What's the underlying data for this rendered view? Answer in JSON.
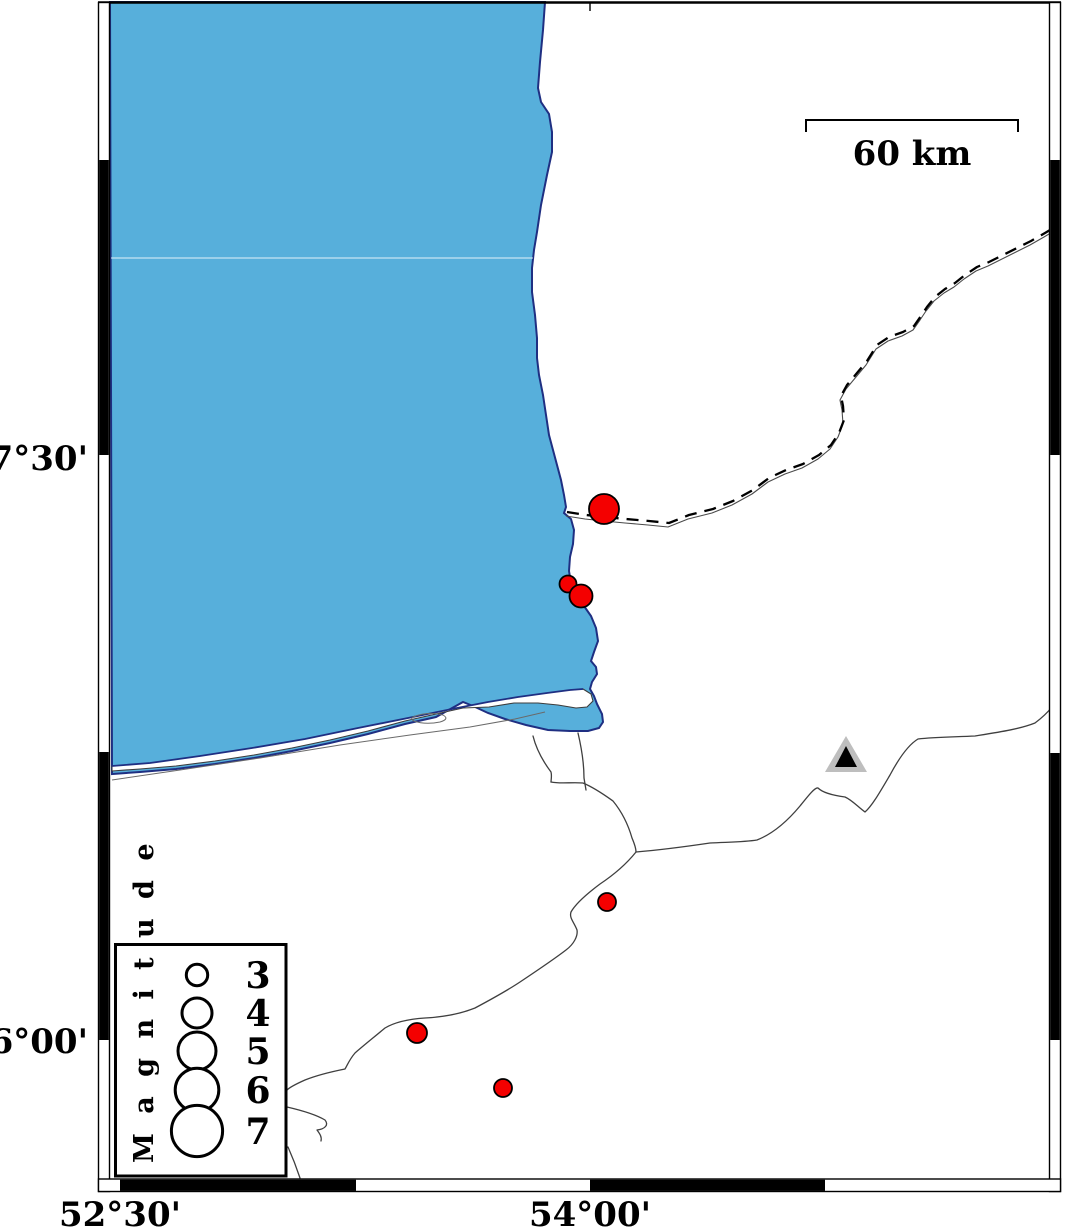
{
  "axes": {
    "left_labels": [
      {
        "text": "37°30'"
      },
      {
        "text": "36°00'"
      }
    ],
    "bottom_labels": [
      {
        "text": "52°30'"
      },
      {
        "text": "54°00'"
      }
    ]
  },
  "scale_bar": {
    "label": "60 km",
    "length_km": 60
  },
  "legend": {
    "title": "M a g n i t u d e",
    "entries": [
      {
        "label": "3",
        "radius": 10.7
      },
      {
        "label": "4",
        "radius": 15
      },
      {
        "label": "5",
        "radius": 19
      },
      {
        "label": "6",
        "radius": 21.8
      },
      {
        "label": "7",
        "radius": 25.6
      }
    ]
  },
  "markers": {
    "earthquakes": [
      {
        "x": 604,
        "y": 509,
        "r": 15
      },
      {
        "x": 568,
        "y": 584,
        "r": 8.5
      },
      {
        "x": 581,
        "y": 596,
        "r": 11.5
      },
      {
        "x": 607,
        "y": 902,
        "r": 9
      },
      {
        "x": 417,
        "y": 1033,
        "r": 10
      },
      {
        "x": 503,
        "y": 1088,
        "r": 9
      }
    ],
    "station": {
      "symbol": "triangle",
      "x": 846,
      "y": 756
    }
  },
  "colors": {
    "sea": "#57AFDB",
    "coastline": "#1f2f82",
    "earthquake_fill": "#f40000",
    "station_outer": "#bebebe",
    "station_inner": "#000000"
  }
}
